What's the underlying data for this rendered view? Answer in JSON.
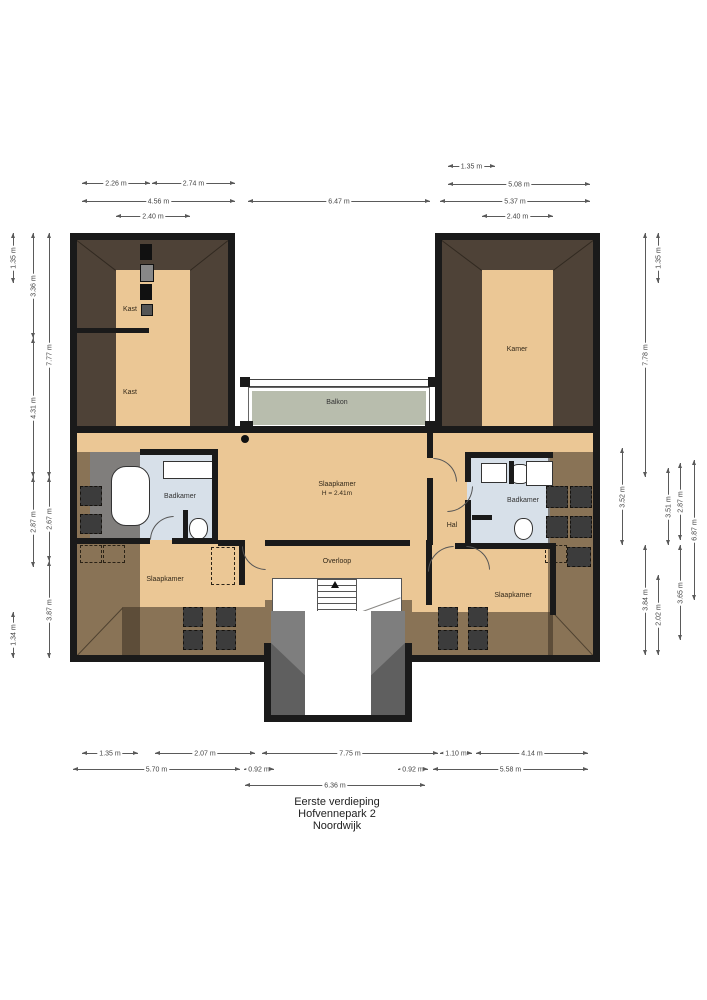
{
  "title": {
    "line1": "Eerste verdieping",
    "line2": "Hofvennepark 2",
    "line3": "Noordwijk"
  },
  "rooms": {
    "kast_top": "Kast",
    "kast_bottom": "Kast",
    "kamer": "Kamer",
    "balkon": "Balkon",
    "slaapkamer_main": "Slaapkamer",
    "slaapkamer_main_height": "H = 2.41m",
    "hal": "Hal",
    "badkamer_left": "Badkamer",
    "badkamer_right": "Badkamer",
    "slaapkamer_left": "Slaapkamer",
    "slaapkamer_right": "Slaapkamer",
    "overloop": "Overloop"
  },
  "dims_top": [
    "2.26 m",
    "2.74 m",
    "4.56 m",
    "2.40 m",
    "6.47 m",
    "1.35 m",
    "5.08 m",
    "5.37 m",
    "2.40 m"
  ],
  "dims_bottom": [
    "1.35 m",
    "2.07 m",
    "7.75 m",
    "1.10 m",
    "4.14 m",
    "5.70 m",
    "0.92 m",
    "0.92 m",
    "5.58 m",
    "6.36 m"
  ],
  "dims_left": [
    "1.35 m",
    "3.36 m",
    "7.77 m",
    "4.31 m",
    "2.87 m",
    "2.67 m",
    "3.87 m",
    "1.34 m"
  ],
  "dims_right": [
    "1.35 m",
    "7.78 m",
    "3.52 m",
    "3.51 m",
    "2.87 m",
    "6.87 m",
    "3.84 m",
    "2.02 m",
    "3.65 m"
  ],
  "colors": {
    "wall": "#1a1a1a",
    "roof_brown": "#4e4237",
    "floor_tan": "#ebc795",
    "bathroom_blue": "#d7e0e9",
    "balcony_green": "#b8bdad",
    "dormer_grey": "#7e7e7e"
  }
}
